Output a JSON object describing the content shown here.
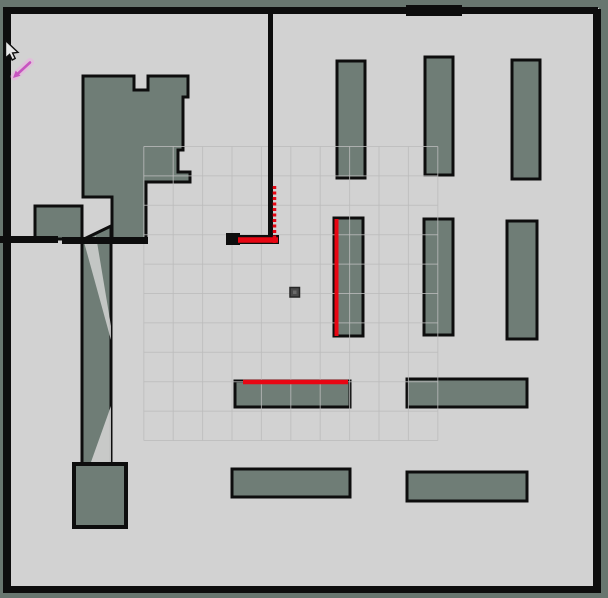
{
  "scene": {
    "width": 608,
    "height": 598,
    "colors": {
      "unknown": "#68766f",
      "free": "#d2d2d2",
      "obstacle": "#6f7d76",
      "wall": "#0d0d0d",
      "grid_line": "#bcbcbc",
      "laser": "#e8randomness0613",
      "laser_red": "#e80613",
      "robot_fill": "#4a4a4a",
      "robot_stroke": "#262626",
      "pose_arrow_core": "#c7 53c0",
      "pose_core": "#c753c0",
      "pose_glow": "#ecb0e2",
      "cursor_fill": "#e8e8e8",
      "cursor_stroke": "#101010"
    },
    "free_space": {
      "x": 5,
      "y": 8,
      "w": 594,
      "h": 584
    },
    "obstacles": [
      {
        "name": "unknown-region-top-left-block",
        "type": "polygon",
        "points": "83,76 134,76 134,90 148,90 148,76 188,76 188,97 183,97 183,150 178,150 178,172 190,172 190,182 146,182 146,240 112,240 112,197 83,197",
        "sw": 3
      },
      {
        "name": "unknown-region-left-protrusion",
        "type": "rect",
        "x": 35,
        "y": 206,
        "w": 47,
        "h": 33,
        "sw": 3
      },
      {
        "name": "unknown-region-corridor",
        "type": "polygon",
        "points": "82,240 111,226 111,464 82,464",
        "sw": 3
      },
      {
        "name": "unknown-region-bottom-left-block",
        "type": "rect",
        "x": 74,
        "y": 464,
        "w": 52,
        "h": 63,
        "sw": 4
      },
      {
        "name": "pillar-top-1",
        "type": "rect",
        "x": 337,
        "y": 61,
        "w": 28,
        "h": 117,
        "sw": 3
      },
      {
        "name": "pillar-top-2",
        "type": "rect",
        "x": 425,
        "y": 57,
        "w": 28,
        "h": 118,
        "sw": 3
      },
      {
        "name": "pillar-top-3",
        "type": "rect",
        "x": 512,
        "y": 60,
        "w": 28,
        "h": 119,
        "sw": 3
      },
      {
        "name": "pillar-mid-1",
        "type": "rect",
        "x": 334,
        "y": 218,
        "w": 29,
        "h": 118,
        "sw": 3
      },
      {
        "name": "pillar-mid-2",
        "type": "rect",
        "x": 424,
        "y": 219,
        "w": 29,
        "h": 116,
        "sw": 3
      },
      {
        "name": "pillar-mid-3",
        "type": "rect",
        "x": 507,
        "y": 221,
        "w": 30,
        "h": 118,
        "sw": 3
      },
      {
        "name": "shelf-bottom-mid-1",
        "type": "rect",
        "x": 235,
        "y": 381,
        "w": 115,
        "h": 26,
        "sw": 3
      },
      {
        "name": "shelf-bottom-mid-2",
        "type": "rect",
        "x": 232,
        "y": 469,
        "w": 118,
        "h": 28,
        "sw": 3
      },
      {
        "name": "shelf-bottom-right-1",
        "type": "rect",
        "x": 407,
        "y": 379,
        "w": 120,
        "h": 28,
        "sw": 3
      },
      {
        "name": "shelf-bottom-right-2",
        "type": "rect",
        "x": 407,
        "y": 472,
        "w": 120,
        "h": 29,
        "sw": 3
      }
    ],
    "free_patches": [
      {
        "name": "corridor-light-streak",
        "points": "84,242 96,236 111,326 111,340",
        "opacity": 0.85
      },
      {
        "name": "corridor-light-wedge",
        "points": "111,406 111,462 91,462",
        "opacity": 0.9
      }
    ],
    "grid": {
      "x0": 143.8,
      "y0": 146.5,
      "step": 29.4,
      "cols": 10,
      "rows": 10,
      "opacity": 0.8
    },
    "walls": [
      {
        "name": "wall-outer-top",
        "x": 4,
        "y": 7,
        "w": 594,
        "h": 7
      },
      {
        "name": "wall-outer-left",
        "x": 3,
        "y": 7,
        "w": 8,
        "h": 586
      },
      {
        "name": "wall-outer-right",
        "x": 593,
        "y": 9,
        "w": 8,
        "h": 584
      },
      {
        "name": "wall-outer-bottom",
        "x": 4,
        "y": 586,
        "w": 597,
        "h": 7
      },
      {
        "name": "wall-top-thick-segment",
        "x": 406,
        "y": 5,
        "w": 56,
        "h": 11
      },
      {
        "name": "wall-center-vertical",
        "x": 268,
        "y": 12,
        "w": 5,
        "h": 230
      },
      {
        "name": "wall-scan-corner-bar",
        "x": 226,
        "y": 235,
        "w": 53,
        "h": 9
      },
      {
        "name": "wall-scan-corner-cap",
        "x": 226,
        "y": 233,
        "w": 14,
        "h": 12
      },
      {
        "name": "wall-under-column",
        "x": 62,
        "y": 237,
        "w": 86,
        "h": 7
      },
      {
        "name": "wall-left-protrusion-link",
        "x": 0,
        "y": 236,
        "w": 58,
        "h": 7
      }
    ],
    "laser_scans": [
      {
        "name": "laser-scan-wall-vertical",
        "x1": 274.5,
        "y1": 186,
        "x2": 274.5,
        "y2": 243,
        "width": 3.5,
        "dash": "3 2.5"
      },
      {
        "name": "laser-scan-corner-horizontal",
        "x1": 238,
        "y1": 240,
        "x2": 278,
        "y2": 240,
        "width": 5.5,
        "dash": ""
      },
      {
        "name": "laser-scan-pillar-edge",
        "x1": 336.5,
        "y1": 219,
        "x2": 336.5,
        "y2": 336,
        "width": 4,
        "dash": ""
      },
      {
        "name": "laser-scan-shelf-edge",
        "x1": 243,
        "y1": 382,
        "x2": 348,
        "y2": 382,
        "width": 4.5,
        "dash": ""
      }
    ],
    "robot": {
      "x": 290,
      "y": 287.5,
      "size": 9.5
    },
    "pose_arrow": {
      "glow": {
        "x1": 30,
        "y1": 62,
        "x2": 14.5,
        "y2": 76.5,
        "width": 8,
        "opacity": 0.55
      },
      "shaft": {
        "x1": 30,
        "y1": 62.5,
        "x2": 17,
        "y2": 74.5,
        "width": 2.6
      },
      "head_points": "13,78 15.7,70.6 20.5,75.8"
    },
    "cursor": {
      "path": "M5.5,40.5 L5.5,58 L9.6,54.4 L12.2,60 L15.2,58.4 L12.6,53 L18,52.4 Z"
    }
  }
}
